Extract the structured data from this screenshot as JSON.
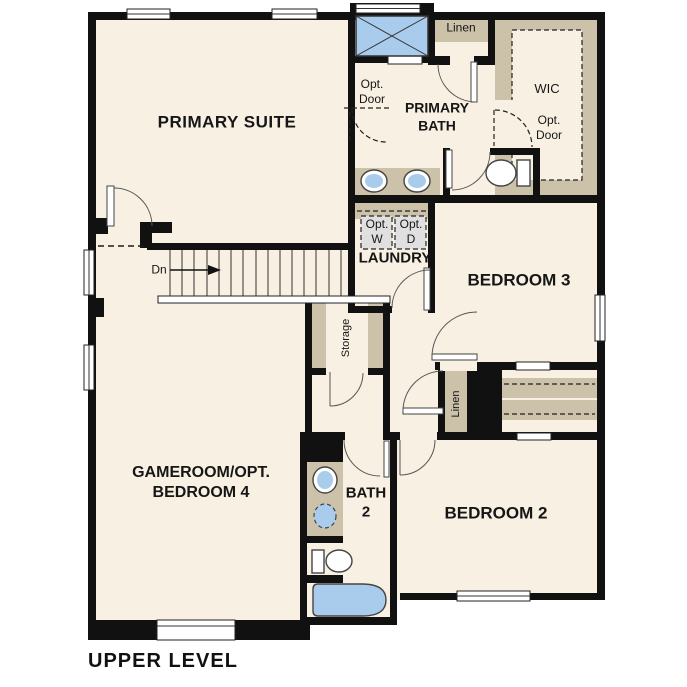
{
  "plan": {
    "title": "UPPER LEVEL",
    "rooms": [
      {
        "id": "primary-suite",
        "label": "PRIMARY SUITE"
      },
      {
        "id": "primary-bath",
        "label": "PRIMARY BATH"
      },
      {
        "id": "wic",
        "label": "WIC"
      },
      {
        "id": "linen-top",
        "label": "Linen"
      },
      {
        "id": "laundry",
        "label": "LAUNDRY"
      },
      {
        "id": "bedroom-3",
        "label": "BEDROOM 3"
      },
      {
        "id": "storage",
        "label": "Storage"
      },
      {
        "id": "linen-middle",
        "label": "Linen"
      },
      {
        "id": "gameroom",
        "label": "GAMEROOM/OPT. BEDROOM 4"
      },
      {
        "id": "bath-2",
        "label": "BATH 2"
      },
      {
        "id": "bedroom-2",
        "label": "BEDROOM 2"
      }
    ],
    "annotations": {
      "stairs_direction": "Dn",
      "opt_door_bath": "Opt. Door",
      "opt_door_wic": "Opt. Door",
      "opt_washer": "Opt. W",
      "opt_dryer": "Opt. D"
    },
    "colors": {
      "page": "#ffffff",
      "floor": "#f8f0e2",
      "casework": "#ccc1a9",
      "fixture_blue": "#a9cbec",
      "appliance_gray": "#e0e0e0",
      "wall": "#111111"
    }
  }
}
